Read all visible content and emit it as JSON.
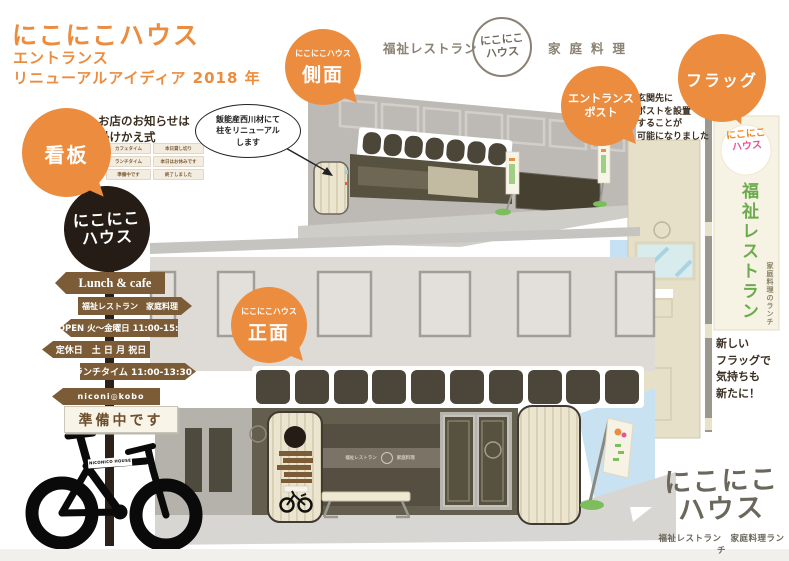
{
  "title": {
    "line1": "にこにこハウス",
    "line2": "エントランス",
    "line3": "リニューアルアイディア 2018 年"
  },
  "header": {
    "left": "福祉レストラン",
    "logo_top": "にこにこ",
    "logo_bottom": "ハウス",
    "right": "家庭料理"
  },
  "bubbles": {
    "side": {
      "small": "にこにこハウス",
      "big": "側面"
    },
    "front": {
      "small": "にこにこハウス",
      "big": "正面"
    },
    "signboard": {
      "big": "看板"
    },
    "entrance_post": {
      "line1": "エントランス",
      "line2": "ポスト"
    },
    "flag": {
      "big": "フラッグ"
    }
  },
  "callout": {
    "text": "飯能産西川材にて\n柱をリニューアル\nします"
  },
  "signboard_note": {
    "heading": "お店のお知らせは\n掛けかえ式",
    "tags": [
      "カフェタイム",
      "本日貸し切り",
      "ランチタイム",
      "本日はお休みです",
      "準備中です",
      "終了しました"
    ]
  },
  "post_note": "玄関先に\nポストを設置\nすることが\n可能になりました",
  "flag_note": "新しい\nフラッグで\n気持ちも\n新たに！",
  "signpost": {
    "logo_top": "にこにこ",
    "logo_bottom": "ハウス",
    "arrows": [
      {
        "label": "Lunch & cafe",
        "dir": "left"
      },
      {
        "label": "福祉レストラン　家庭料理",
        "dir": "right"
      },
      {
        "label": "OPEN 火〜金曜日 11:00-15:00",
        "dir": "left"
      },
      {
        "label": "定休日　土 日 月 祝日",
        "dir": "left"
      },
      {
        "label": "ランチタイム 11:00-13:30",
        "dir": "right"
      },
      {
        "label": "niconi◎kobo",
        "dir": "left"
      }
    ],
    "status": "準備中です"
  },
  "storefront_sign": {
    "left": "福祉レストラン",
    "right": "家庭料理"
  },
  "flag": {
    "logo_top": "にこにこ",
    "logo_bottom": "ハウス",
    "main_vertical": "福祉レストラン",
    "sub_vertical": "家庭料理のランチ"
  },
  "bike_label": "NICONICO HOUSE",
  "bottom_logo": {
    "line1": "にこにこ",
    "line2": "ハウス",
    "subtitle": "福祉レストラン　家庭料理ランチ"
  },
  "colors": {
    "accent_orange": "#EC8C3F",
    "sign_dark_brown": "#241C15",
    "arrow_brown": "#7B5C37",
    "olive_text": "#8A8274",
    "flag_green": "#6CAB4D",
    "logo_pink": "#E85298",
    "sky_blue": "#C8E2F2",
    "cream": "#EBE4CE",
    "storefront_olive": "#645E4F"
  }
}
